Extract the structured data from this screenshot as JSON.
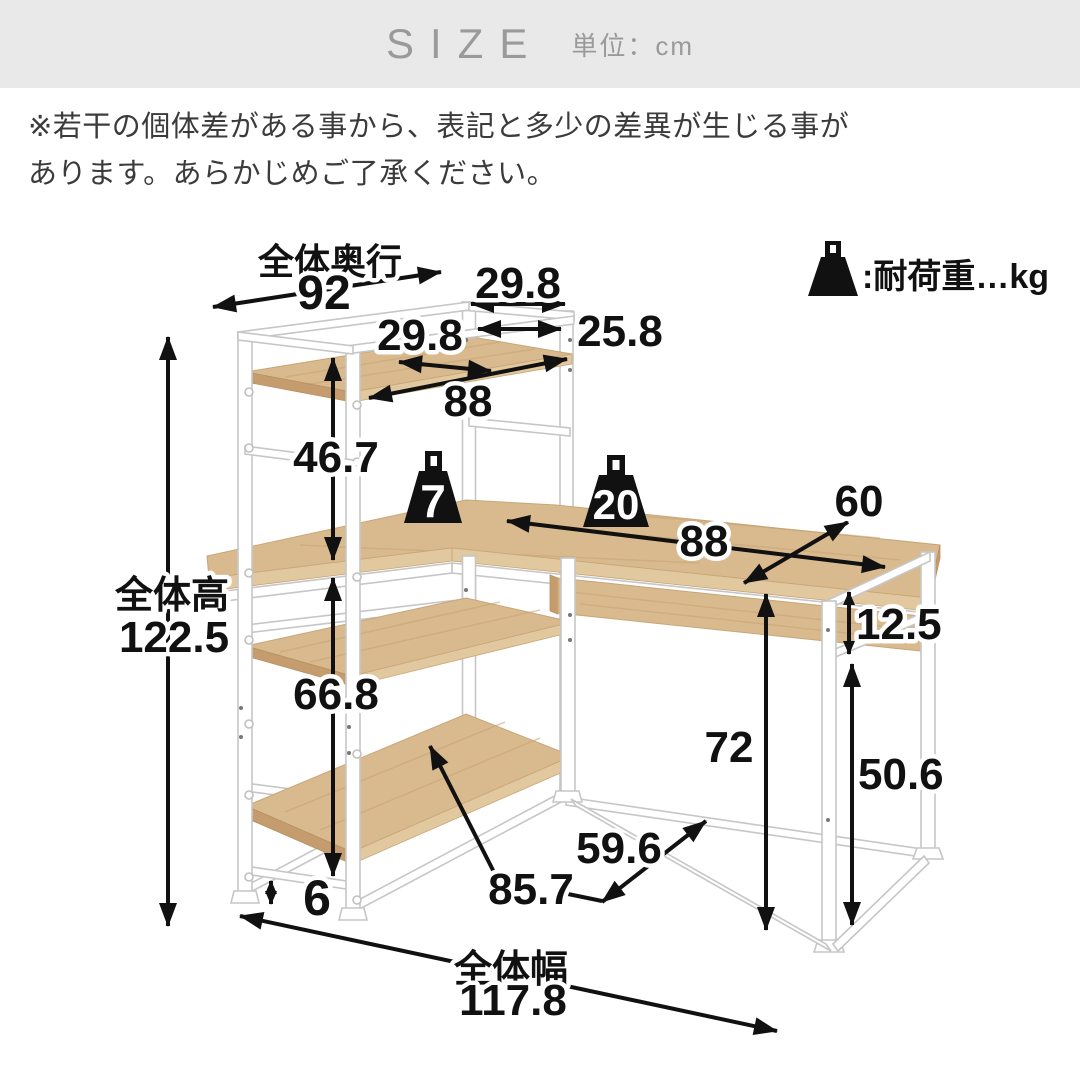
{
  "header": {
    "title": "SIZE",
    "unit": "単位：cm"
  },
  "note": {
    "line1": "※若干の個体差がある事から、表記と多少の差異が生じる事が",
    "line2": "あります。あらかじめご了承ください。"
  },
  "legend": {
    "label": ":耐荷重…kg"
  },
  "loads": {
    "hutch_shelf_kg": "7",
    "desk_kg": "20"
  },
  "dims": {
    "overall_depth_label": "全体奥行",
    "overall_depth": "92",
    "hutch_outer_width": "29.8",
    "hutch_inner_width": "25.8",
    "hutch_shelf_depth": "29.8",
    "hutch_shelf_length": "88",
    "hutch_clearance": "46.7",
    "overall_height_label": "全体高",
    "overall_height": "122.5",
    "under_desk_clearance": "66.8",
    "floor_clearance": "6",
    "desk_top_length": "88",
    "desk_top_depth": "60",
    "apron_height": "12.5",
    "desk_height": "72",
    "leg_inner_height": "50.6",
    "floor_diagonal": "59.6",
    "bottom_shelf_length": "85.7",
    "overall_width_label": "全体幅",
    "overall_width": "117.8"
  },
  "colors": {
    "wood_top": "#d9ba8e",
    "wood_edge_light": "#e2c89e",
    "wood_edge_dark": "#c49c6d",
    "frame_white": "#ffffff",
    "frame_outline": "#c6c6c6",
    "ink": "#111111",
    "header_bg": "#e9e9e9",
    "header_fg": "#9a9a9a",
    "note_fg": "#3b3b3b"
  }
}
